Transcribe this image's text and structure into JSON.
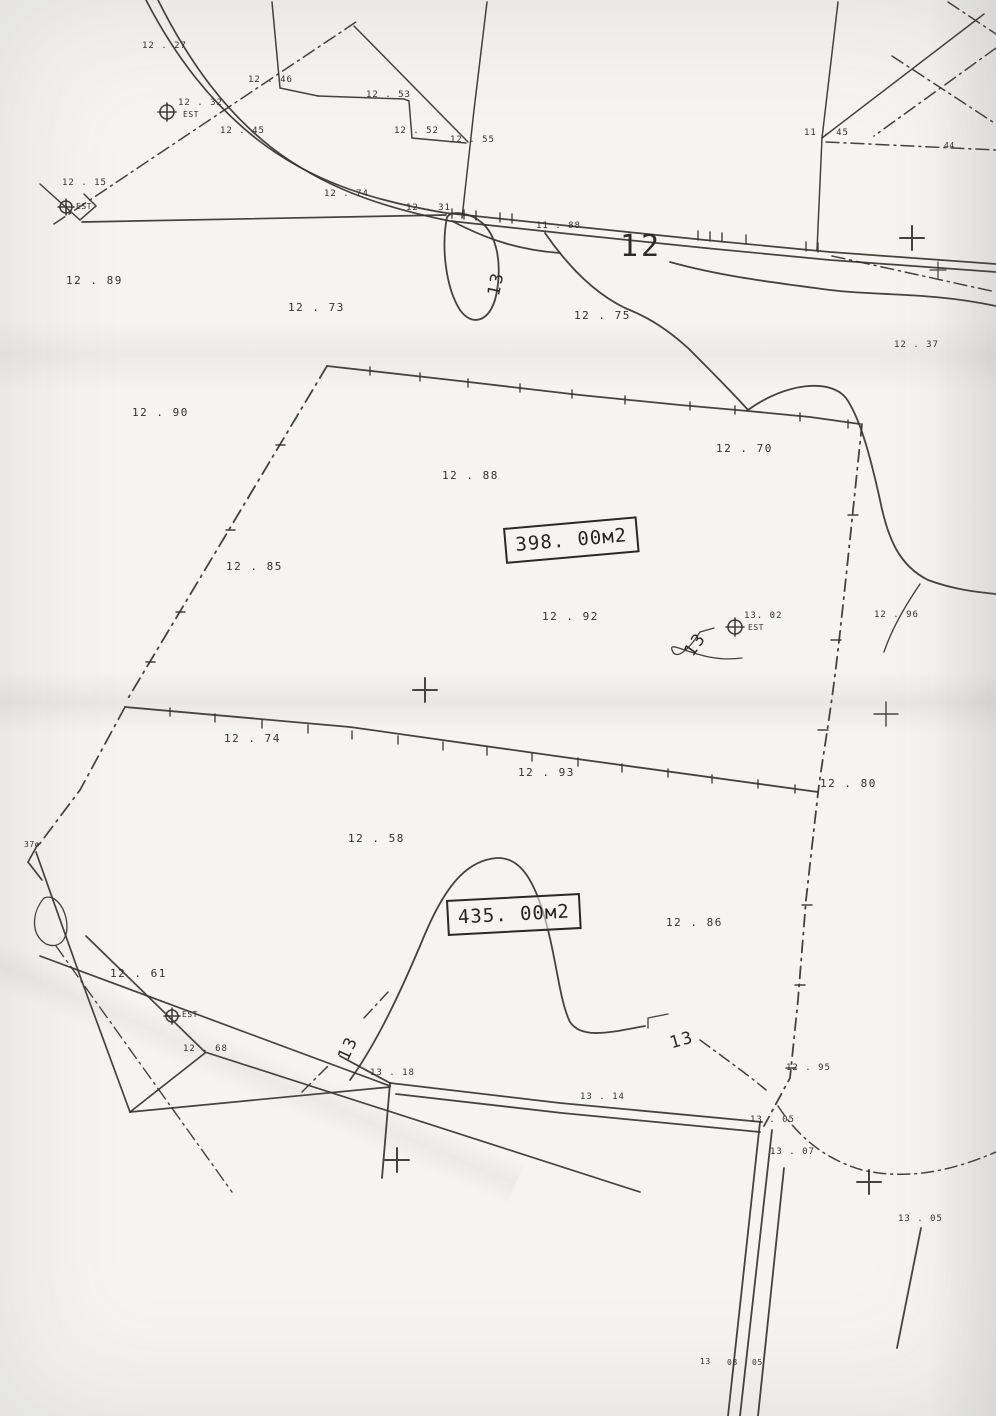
{
  "document_kind": "scanned cadastral survey plan",
  "colors": {
    "ink": "#34322c",
    "paper": "#f5f4f0"
  },
  "area_boxes": [
    {
      "text": "398. 00м2"
    },
    {
      "text": "435. 00м2"
    }
  ],
  "labels": [
    {
      "kind": "spot",
      "text": "12 . 27"
    },
    {
      "kind": "spot",
      "text": "12 . 46"
    },
    {
      "kind": "marker",
      "text": "12 . 32"
    },
    {
      "kind": "marker-sub",
      "text": "EST"
    },
    {
      "kind": "spot",
      "text": "12 . 45"
    },
    {
      "kind": "spot",
      "text": "12 . 53"
    },
    {
      "kind": "spot",
      "text": "12 . 52"
    },
    {
      "kind": "spot",
      "text": "12 . 55"
    },
    {
      "kind": "spot",
      "text": "12 . 15"
    },
    {
      "kind": "marker-sub",
      "text": "EST"
    },
    {
      "kind": "spot",
      "text": "12 . 74"
    },
    {
      "kind": "spot",
      "text": "12 . 31"
    },
    {
      "kind": "spot",
      "text": "11 . 88"
    },
    {
      "kind": "contour",
      "text": "12"
    },
    {
      "kind": "spot",
      "text": "11 . 45"
    },
    {
      "kind": "spot",
      "text": "44"
    },
    {
      "kind": "spot",
      "text": "12 . 89"
    },
    {
      "kind": "spot",
      "text": "12 . 73"
    },
    {
      "kind": "spot",
      "text": "12 . 75"
    },
    {
      "kind": "spot",
      "text": "12 . 37"
    },
    {
      "kind": "contour",
      "text": "13"
    },
    {
      "kind": "spot",
      "text": "12 . 90"
    },
    {
      "kind": "spot",
      "text": "12 . 70"
    },
    {
      "kind": "spot",
      "text": "12 . 88"
    },
    {
      "kind": "spot",
      "text": "12 . 85"
    },
    {
      "kind": "spot",
      "text": "12 . 92"
    },
    {
      "kind": "contour",
      "text": "13"
    },
    {
      "kind": "marker",
      "text": "13. 02"
    },
    {
      "kind": "marker-sub",
      "text": "EST"
    },
    {
      "kind": "spot",
      "text": "12 . 96"
    },
    {
      "kind": "spot",
      "text": "12 . 74"
    },
    {
      "kind": "spot",
      "text": "12 . 93"
    },
    {
      "kind": "spot",
      "text": "12 . 80"
    },
    {
      "kind": "spot",
      "text": "12 . 58"
    },
    {
      "kind": "spot",
      "text": "12 . 86"
    },
    {
      "kind": "spot",
      "text": "37o"
    },
    {
      "kind": "spot",
      "text": "12 . 61"
    },
    {
      "kind": "marker-sub",
      "text": "EST"
    },
    {
      "kind": "spot",
      "text": "12 . 68"
    },
    {
      "kind": "contour",
      "text": "13"
    },
    {
      "kind": "contour",
      "text": "13"
    },
    {
      "kind": "spot",
      "text": "13 . 18"
    },
    {
      "kind": "spot",
      "text": "13 . 14"
    },
    {
      "kind": "spot",
      "text": "13 . 05"
    },
    {
      "kind": "spot",
      "text": "12 . 95"
    },
    {
      "kind": "spot",
      "text": "13 . 07"
    },
    {
      "kind": "spot",
      "text": "13 . 05"
    },
    {
      "kind": "spot",
      "text": "13"
    },
    {
      "kind": "spot",
      "text": "08"
    },
    {
      "kind": "spot",
      "text": "05"
    }
  ]
}
